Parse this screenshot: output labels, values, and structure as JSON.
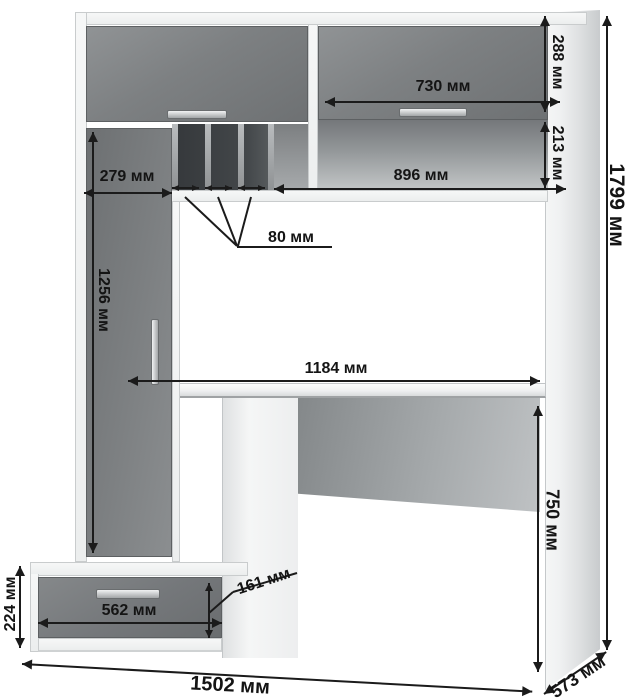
{
  "diagram": {
    "type": "furniture-dimension-drawing",
    "subject": "computer desk with hutch, tall cabinet and drawer pedestal",
    "unit": "мм",
    "labels": {
      "upper_right_door_height": "288 мм",
      "upper_right_door_width": "730 мм",
      "upper_niche_height": "213 мм",
      "upper_niche_width": "896 мм",
      "left_cabinet_width": "279 мм",
      "pigeonhole_slot_width": "80 мм",
      "left_door_height": "1256 мм",
      "desktop_width": "1184 мм",
      "overall_height": "1799 мм",
      "desk_height": "750 мм",
      "drawer_front_height": "161 мм",
      "drawer_width": "562 мм",
      "drawer_unit_height": "224 мм",
      "overall_width": "1502 мм",
      "overall_depth": "573 мм"
    },
    "colors": {
      "background": "#ffffff",
      "carcass_white": "#f2f3f4",
      "front_grey": "#7d8082",
      "niche_shadow": "#3a3d40",
      "dimension_ink": "#1b1b1b"
    }
  }
}
